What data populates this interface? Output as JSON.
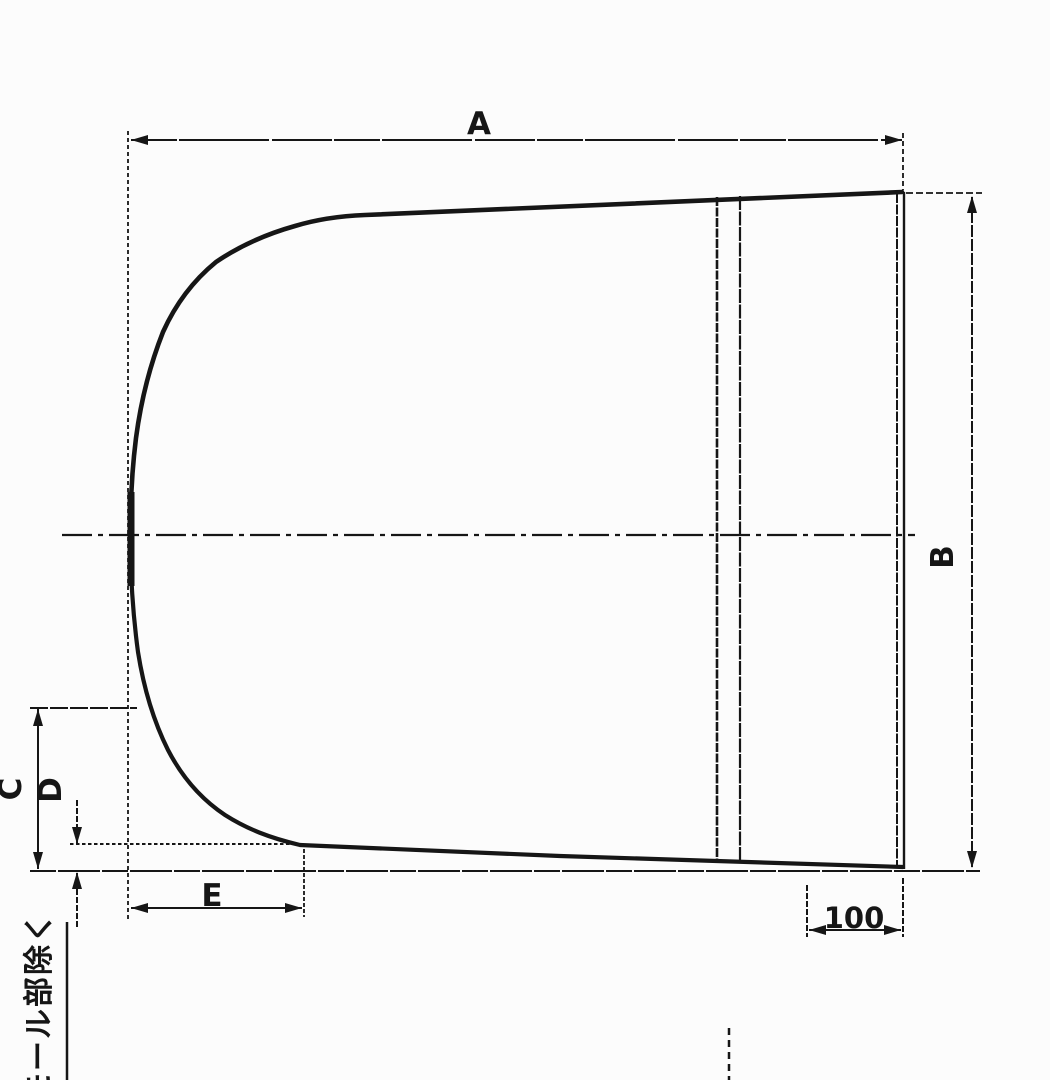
{
  "drawing": {
    "dimensions": {
      "a": {
        "label": "A"
      },
      "b": {
        "label": "B"
      },
      "c": {
        "label": "C"
      },
      "d": {
        "label": "D"
      },
      "e": {
        "label": "E"
      },
      "right_flat_width": {
        "label": "100"
      }
    },
    "note": {
      "text": "モール部除く"
    },
    "colors": {
      "ink": "#161616",
      "paper": "#fcfcfc"
    }
  }
}
